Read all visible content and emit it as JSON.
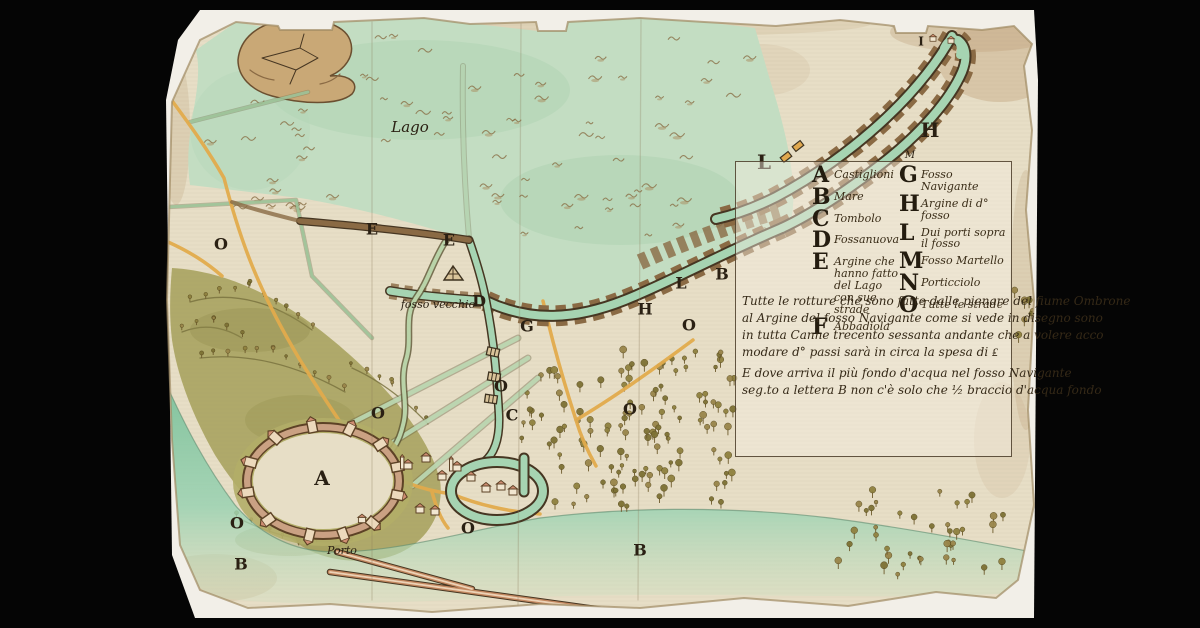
{
  "colors": {
    "paper": "#e7dec6",
    "backing": "#f2efe8",
    "lake": "#c3ddc2",
    "water": "#a6d4b2",
    "sea": "#8cc9a4",
    "outline": "#463622",
    "embank": "#8a6a44",
    "road": "#e2ab4c",
    "hills": "#a9a35f",
    "hillsdark": "#7a7340",
    "knoll": "#b3ad68",
    "ink": "#2a2013",
    "stain": "#b6946a",
    "wallpink": "#cf9d7d",
    "houseroof": "#cf8d72"
  },
  "legend": {
    "left": [
      {
        "letter": "A",
        "label": "Castiglioni"
      },
      {
        "letter": "B",
        "label": "Mare"
      },
      {
        "letter": "C",
        "label": "Tombolo"
      },
      {
        "letter": "D",
        "label": "Fossanuova"
      },
      {
        "letter": "E",
        "label": "Argine che hanno fatto del Lago con sue strade"
      },
      {
        "letter": "F",
        "label": "Abbadiola"
      }
    ],
    "right": [
      {
        "letter": "G",
        "label": "Fosso Navigante"
      },
      {
        "letter": "H",
        "label": "Argine di d° fosso"
      },
      {
        "letter": "L",
        "label": "Dui porti sopra il fosso"
      },
      {
        "letter": "M",
        "label": "Fosso Martello"
      },
      {
        "letter": "N",
        "label": "Porticciolo"
      },
      {
        "letter": "O",
        "label": "Tutte le strade"
      }
    ]
  },
  "notes": {
    "paragraph1": [
      "Tutte le rotture che sono fatte dalle pienare del fiume Ombrone",
      "al Argine del fosso Navigante come si vede in disegno sono",
      "in tutta Canne trecento sessanta andante che a volere acco",
      "modare d° passi sarà in circa la spesa di ₤"
    ],
    "paragraph2": [
      "E dove arriva il più fondo d'acqua nel fosso Navigante",
      "seg.to a lettera B non c'è solo che ½ braccio d'acqua fondo"
    ]
  },
  "map_labels": [
    {
      "text": "Lago",
      "x": 410,
      "y": 128,
      "cls": "cursive"
    },
    {
      "text": "fosso vecchio",
      "x": 438,
      "y": 305,
      "cls": "cursive-sm"
    },
    {
      "text": "Porto",
      "x": 342,
      "y": 551,
      "cls": "cursive-sm"
    },
    {
      "text": "O",
      "x": 221,
      "y": 245,
      "cls": "letter"
    },
    {
      "text": "E",
      "x": 372,
      "y": 230,
      "cls": "letter"
    },
    {
      "text": "E",
      "x": 449,
      "y": 241,
      "cls": "letter"
    },
    {
      "text": "D",
      "x": 479,
      "y": 302,
      "cls": "letter"
    },
    {
      "text": "G",
      "x": 527,
      "y": 327,
      "cls": "letter"
    },
    {
      "text": "H",
      "x": 645,
      "y": 310,
      "cls": "letter"
    },
    {
      "text": "L",
      "x": 681,
      "y": 284,
      "cls": "letter"
    },
    {
      "text": "B",
      "x": 722,
      "y": 275,
      "cls": "letter"
    },
    {
      "text": "O",
      "x": 689,
      "y": 326,
      "cls": "letter"
    },
    {
      "text": "O",
      "x": 501,
      "y": 387,
      "cls": "letter"
    },
    {
      "text": "C",
      "x": 512,
      "y": 416,
      "cls": "letter"
    },
    {
      "text": "O",
      "x": 630,
      "y": 410,
      "cls": "letter"
    },
    {
      "text": "O",
      "x": 378,
      "y": 414,
      "cls": "letter"
    },
    {
      "text": "A",
      "x": 322,
      "y": 479,
      "cls": "letter-lg"
    },
    {
      "text": "O",
      "x": 237,
      "y": 524,
      "cls": "letter"
    },
    {
      "text": "B",
      "x": 241,
      "y": 565,
      "cls": "letter"
    },
    {
      "text": "O",
      "x": 468,
      "y": 529,
      "cls": "letter"
    },
    {
      "text": "B",
      "x": 640,
      "y": 551,
      "cls": "letter"
    },
    {
      "text": "L",
      "x": 764,
      "y": 163,
      "cls": "letter-lg"
    },
    {
      "text": "H",
      "x": 930,
      "y": 131,
      "cls": "letter-lg"
    },
    {
      "text": "M",
      "x": 910,
      "y": 156,
      "cls": "cursive-xs"
    },
    {
      "text": "I",
      "x": 921,
      "y": 42,
      "cls": "letter-sm"
    }
  ]
}
